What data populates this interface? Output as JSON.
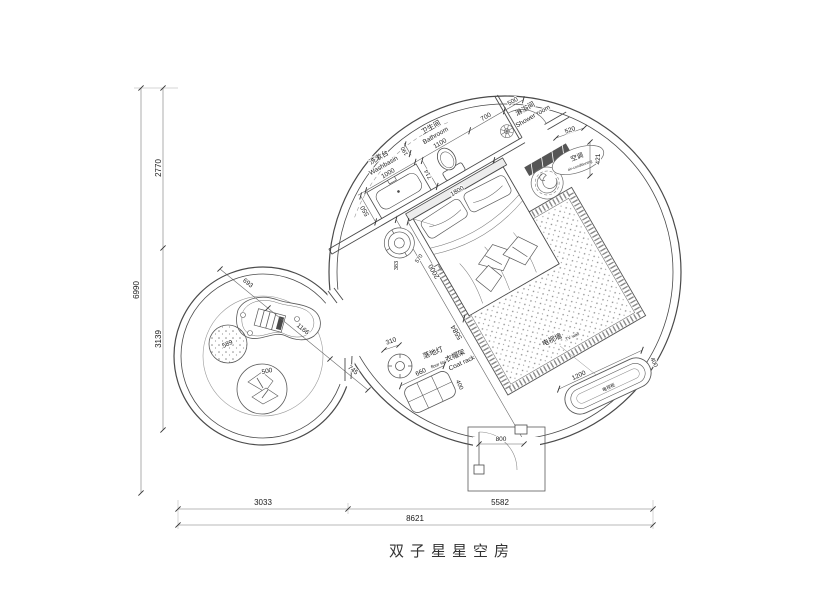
{
  "title": "双子星星空房",
  "rooms": {
    "washbasin": {
      "zh": "洗漱台",
      "en": "Washbasin"
    },
    "bathroom": {
      "zh": "卫生间",
      "en": "Bathroom"
    },
    "shower": {
      "zh": "淋浴间",
      "en": "Shower room"
    },
    "ac": {
      "zh": "空调",
      "en": "air-conditioning"
    },
    "floor_lamp": {
      "zh": "落地灯",
      "en": "floor lamp"
    },
    "coat_rack": {
      "zh": "衣帽架",
      "en": "Coat rack"
    },
    "tv_wall": {
      "zh": "电视墙",
      "en": "TV wall"
    },
    "tv_cabinet": {
      "zh": "电视柜"
    }
  },
  "dims": {
    "left_upper": "2770",
    "left_total": "6990",
    "left_lower": "3139",
    "bottom_left": "3033",
    "bottom_right": "5582",
    "bottom_total": "8621",
    "washbasin_w": "1000",
    "bathroom_w": "1100",
    "niche": "190",
    "d700": "700",
    "shower_door": "500",
    "d520": "520",
    "d421": "421",
    "vanity_d": "550",
    "d714": "714",
    "d590": "590",
    "bed_w": "1800",
    "bed_l": "2000",
    "d383": "383",
    "d570": "570",
    "room_diag": "5584",
    "lamp_d": "310",
    "rack_w": "660",
    "rack_d": "400",
    "tv_len": "1200",
    "tv_gap": "400",
    "entry_w": "800",
    "s_seg1": "693",
    "s_seg2": "1166",
    "s_seg3": "745",
    "stool_d": "589",
    "chair_d": "500"
  },
  "colors": {
    "wall": "#4a4a4a",
    "line": "#6a6a6a",
    "dim_text": "#1a1a1a",
    "dark_fill": "#555555",
    "background": "#ffffff"
  }
}
